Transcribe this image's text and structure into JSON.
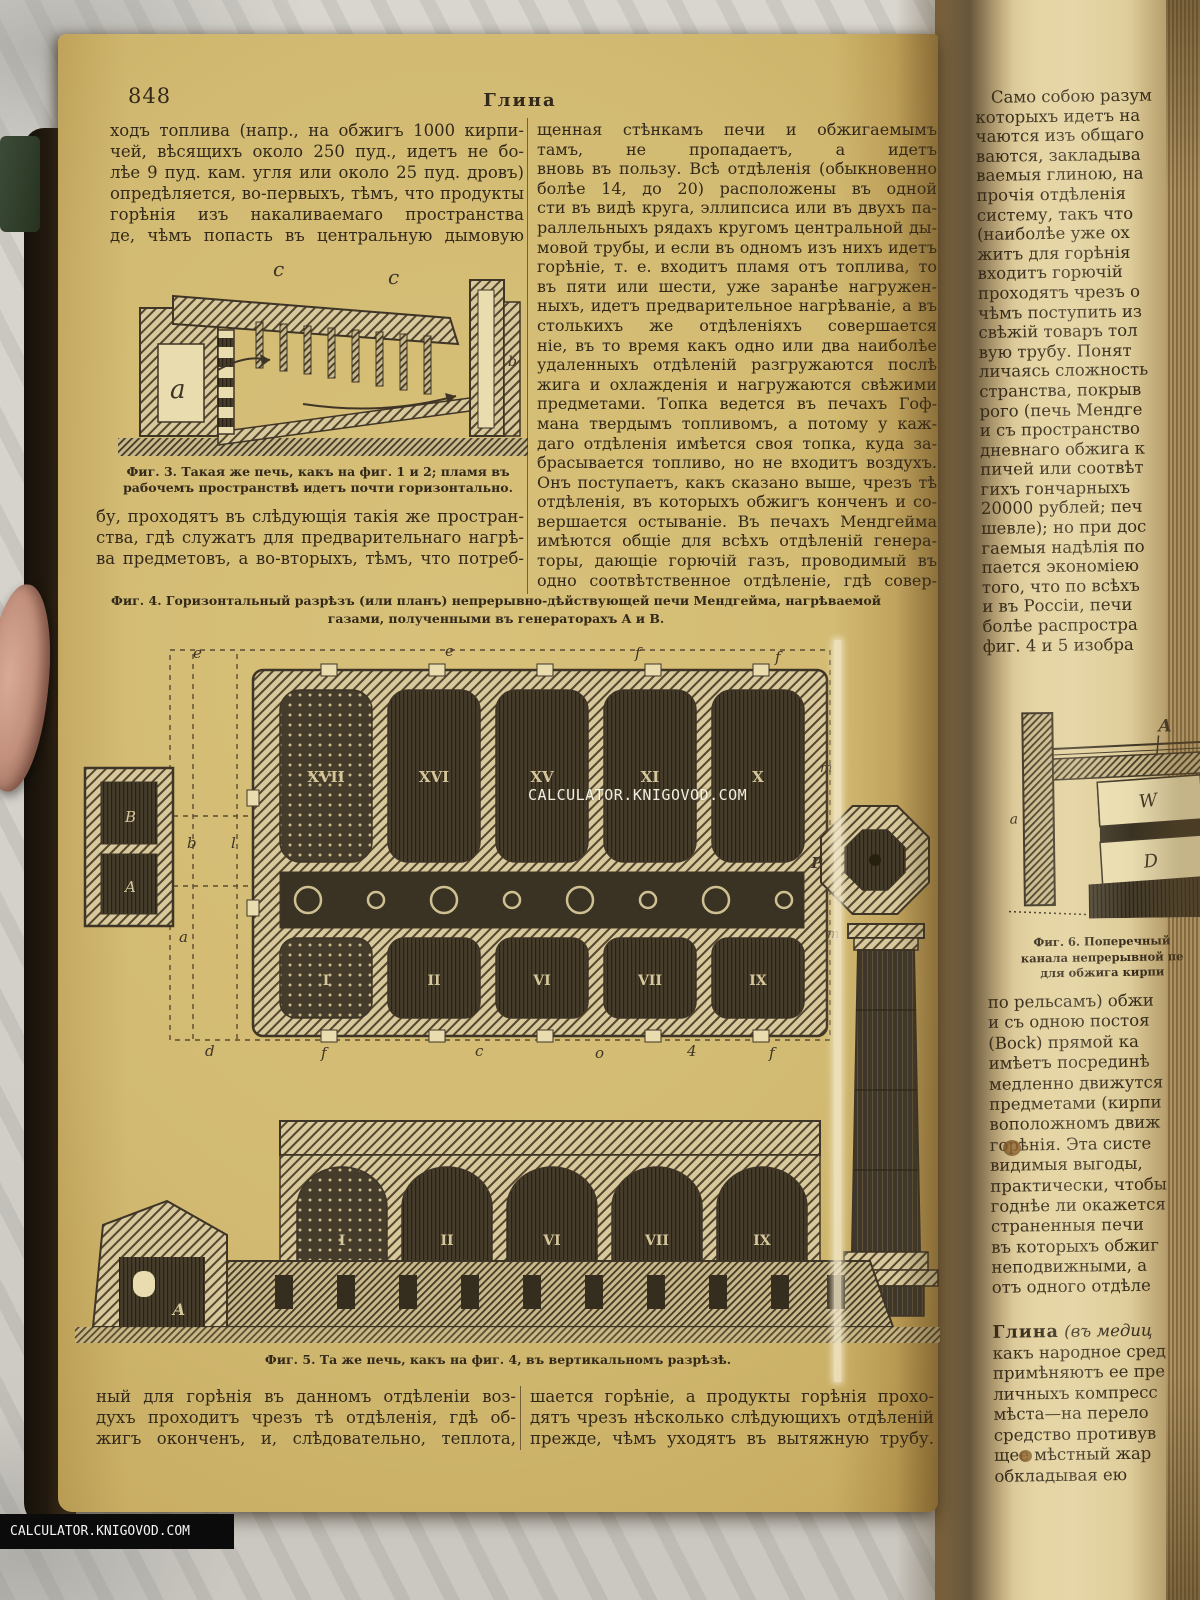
{
  "watermark": {
    "text": "CALCULATOR.KNIGOVOD.COM"
  },
  "page_left": {
    "page_number": "848",
    "running_title": "Глина",
    "col1_top_lines": [
      "ходъ топлива (напр., на обжигъ 1000 кирпи-",
      "чей, вѣсящихъ около 250 пуд., идетъ не бо-",
      "лѣе 9 пуд. кам. угля или около 25 пуд. дровъ)",
      "опредѣляется, во-первыхъ, тѣмъ, что продукты",
      "горѣнія изъ накаливаемаго пространства преж-",
      "де, чѣмъ попасть въ центральную дымовую тру-"
    ],
    "fig3": {
      "caption_lines": [
        "Фиг. 3. Такая же печь, какъ на фиг. 1 и 2; пламя въ",
        "рабочемъ пространствѣ идетъ почти горизонтально."
      ],
      "labels": {
        "c1": "c",
        "c2": "c",
        "a": "a",
        "b": "b"
      }
    },
    "col1_bottom_lines": [
      "бу, проходятъ въ слѣдующія такія же простран-",
      "ства, гдѣ служатъ для предварительнаго нагрѣ-",
      "ва предметовъ, а во-вторыхъ, тѣмъ, что потреб-"
    ],
    "col2_lines": [
      "щенная стѣнкамъ печи и обжигаемымъ предме-",
      "тамъ, не пропадаетъ, а идетъ (регенерируется)",
      "вновь въ пользу. Всѣ отдѣленія (обыкновенно",
      "болѣе 14, до 20) расположены въ одной плоско-",
      "сти въ видѣ круга, эллипсиса или въ двухъ па-",
      "раллельныхъ рядахъ кругомъ центральной ды-",
      "мовой трубы, и если въ одномъ изъ нихъ идетъ",
      "горѣніе, т. е. входитъ пламя отъ топлива, то",
      "въ пяти или шести, уже заранѣе нагружен-",
      "ныхъ, идетъ предварительное нагрѣваніе, а въ",
      "столькихъ же отдѣленіяхъ совершается охлажде-",
      "ніе, въ то время какъ одно или два наиболѣе",
      "удаленныхъ отдѣленій разгружаются послѣ об-",
      "жига и охлажденія и нагружаются свѣжими",
      "предметами. Топка ведется въ печахъ Гоф-",
      "мана твердымъ топливомъ, а потому у каж-",
      "даго отдѣленія имѣется своя топка, куда за-",
      "брасывается топливо, но не входитъ воздухъ.",
      "Онъ поступаетъ, какъ сказано выше, чрезъ тѣ",
      "отдѣленія, въ которыхъ обжигъ конченъ и со-",
      "вершается остываніе. Въ печахъ Мендгейма",
      "имѣются общіе для всѣхъ отдѣленій генера-",
      "торы, дающіе горючій газъ, проводимый въ",
      "одно соотвѣтственное отдѣленіе, гдѣ совер-"
    ],
    "fig4": {
      "caption_lines": [
        "Фиг. 4. Горизонтальный разрѣзъ (или планъ) непрерывно-дѣйствующей печи Мендгейма, нагрѣваемой генераторными",
        "газами, полученными въ генераторахъ A и B."
      ],
      "top_row_numerals": [
        "XVII",
        "XVI",
        "XV",
        "XI",
        "X"
      ],
      "bottom_row_numerals": [
        "I",
        "II",
        "VI",
        "VII",
        "IX"
      ],
      "labels": {
        "generator_top": "B",
        "generator_bottom": "A",
        "left1": "b",
        "left2": "l",
        "left3": "a",
        "top1": "e",
        "top2": "e",
        "top3": "f",
        "top4": "f",
        "right1": "m",
        "right2": "m",
        "chimney": "P",
        "bottom1": "d",
        "bottom2": "f",
        "bottom3": "c",
        "bottom4": "o",
        "bottom5": "4",
        "bottom6": "f"
      }
    },
    "fig5": {
      "caption": "Фиг. 5. Та же печь, какъ на фиг. 4, въ вертикальномъ разрѣзѣ.",
      "numerals": [
        "I",
        "II",
        "VI",
        "VII",
        "IX"
      ],
      "label_a": "A"
    },
    "bottom_col1_lines": [
      "ный для горѣнія въ данномъ отдѣленіи воз-",
      "духъ проходитъ чрезъ тѣ отдѣленія, гдѣ об-",
      "жигъ оконченъ, и, слѣдовательно, теплота, сооб-"
    ],
    "bottom_col2_lines": [
      "шается горѣніе, а продукты горѣнія прохо-",
      "дятъ чрезъ нѣсколько слѣдующихъ отдѣленій",
      "прежде, чѣмъ уходятъ въ вытяжную трубу."
    ]
  },
  "page_right": {
    "top_lines": [
      "   Само собою разум",
      "которыхъ идетъ на",
      "чаются изъ общаго",
      "ваются, закладыва",
      "ваемыя глиною, на",
      "прочія отдѣленія",
      "систему, такъ что",
      "(наиболѣе уже ох",
      "житъ для горѣнія",
      "входитъ горючій",
      "проходятъ чрезъ о",
      "чѣмъ поступить из",
      "свѣжій товаръ тол",
      "вую трубу. Понят",
      "личаясь сложность",
      "странства, покрыв",
      "рого (печь Мендге",
      "и съ пространство",
      "дневнаго обжига к",
      "пичей или соотвѣт",
      "гихъ гончарныхъ",
      "20000 рублей; печ",
      "шевле); но при дос",
      "гаемыя надѣлія по",
      "пается экономіею",
      "того, что по всѣхъ",
      "и въ Россіи, печи",
      "болѣе распростра",
      "фиг. 4 и 5 изобра"
    ],
    "fig6": {
      "caption_lines": [
        "Фиг. 6. Поперечный",
        "канала непрерывной пе",
        "для обжига кирпи"
      ],
      "labels": {
        "A": "A",
        "W": "W",
        "D": "D",
        "a": "a"
      }
    },
    "mid_lines": [
      "по рельсамъ) обжи",
      "и съ одною постоя",
      "(Bock) прямой ка",
      "имѣетъ посрединѣ",
      "медленно движутся",
      "предметами (кирпи",
      "воположномъ движ",
      "горѣнія. Эта систе",
      "видимыя выгоды,",
      "практически, чтобы",
      "годнѣе ли окажется",
      "страненныя печи",
      "въ которыхъ обжиг",
      "неподвижными, а",
      "отъ одного отдѣле"
    ],
    "entry": {
      "headword": "Глина",
      "first_line_rest": " (въ медиц",
      "lines": [
        "какъ народное сред",
        "примѣняютъ ее пре",
        "личныхъ компресс",
        "мѣста—на перело",
        "средство противув",
        "щее мѣстный жар",
        "обкладывая ею"
      ]
    }
  }
}
